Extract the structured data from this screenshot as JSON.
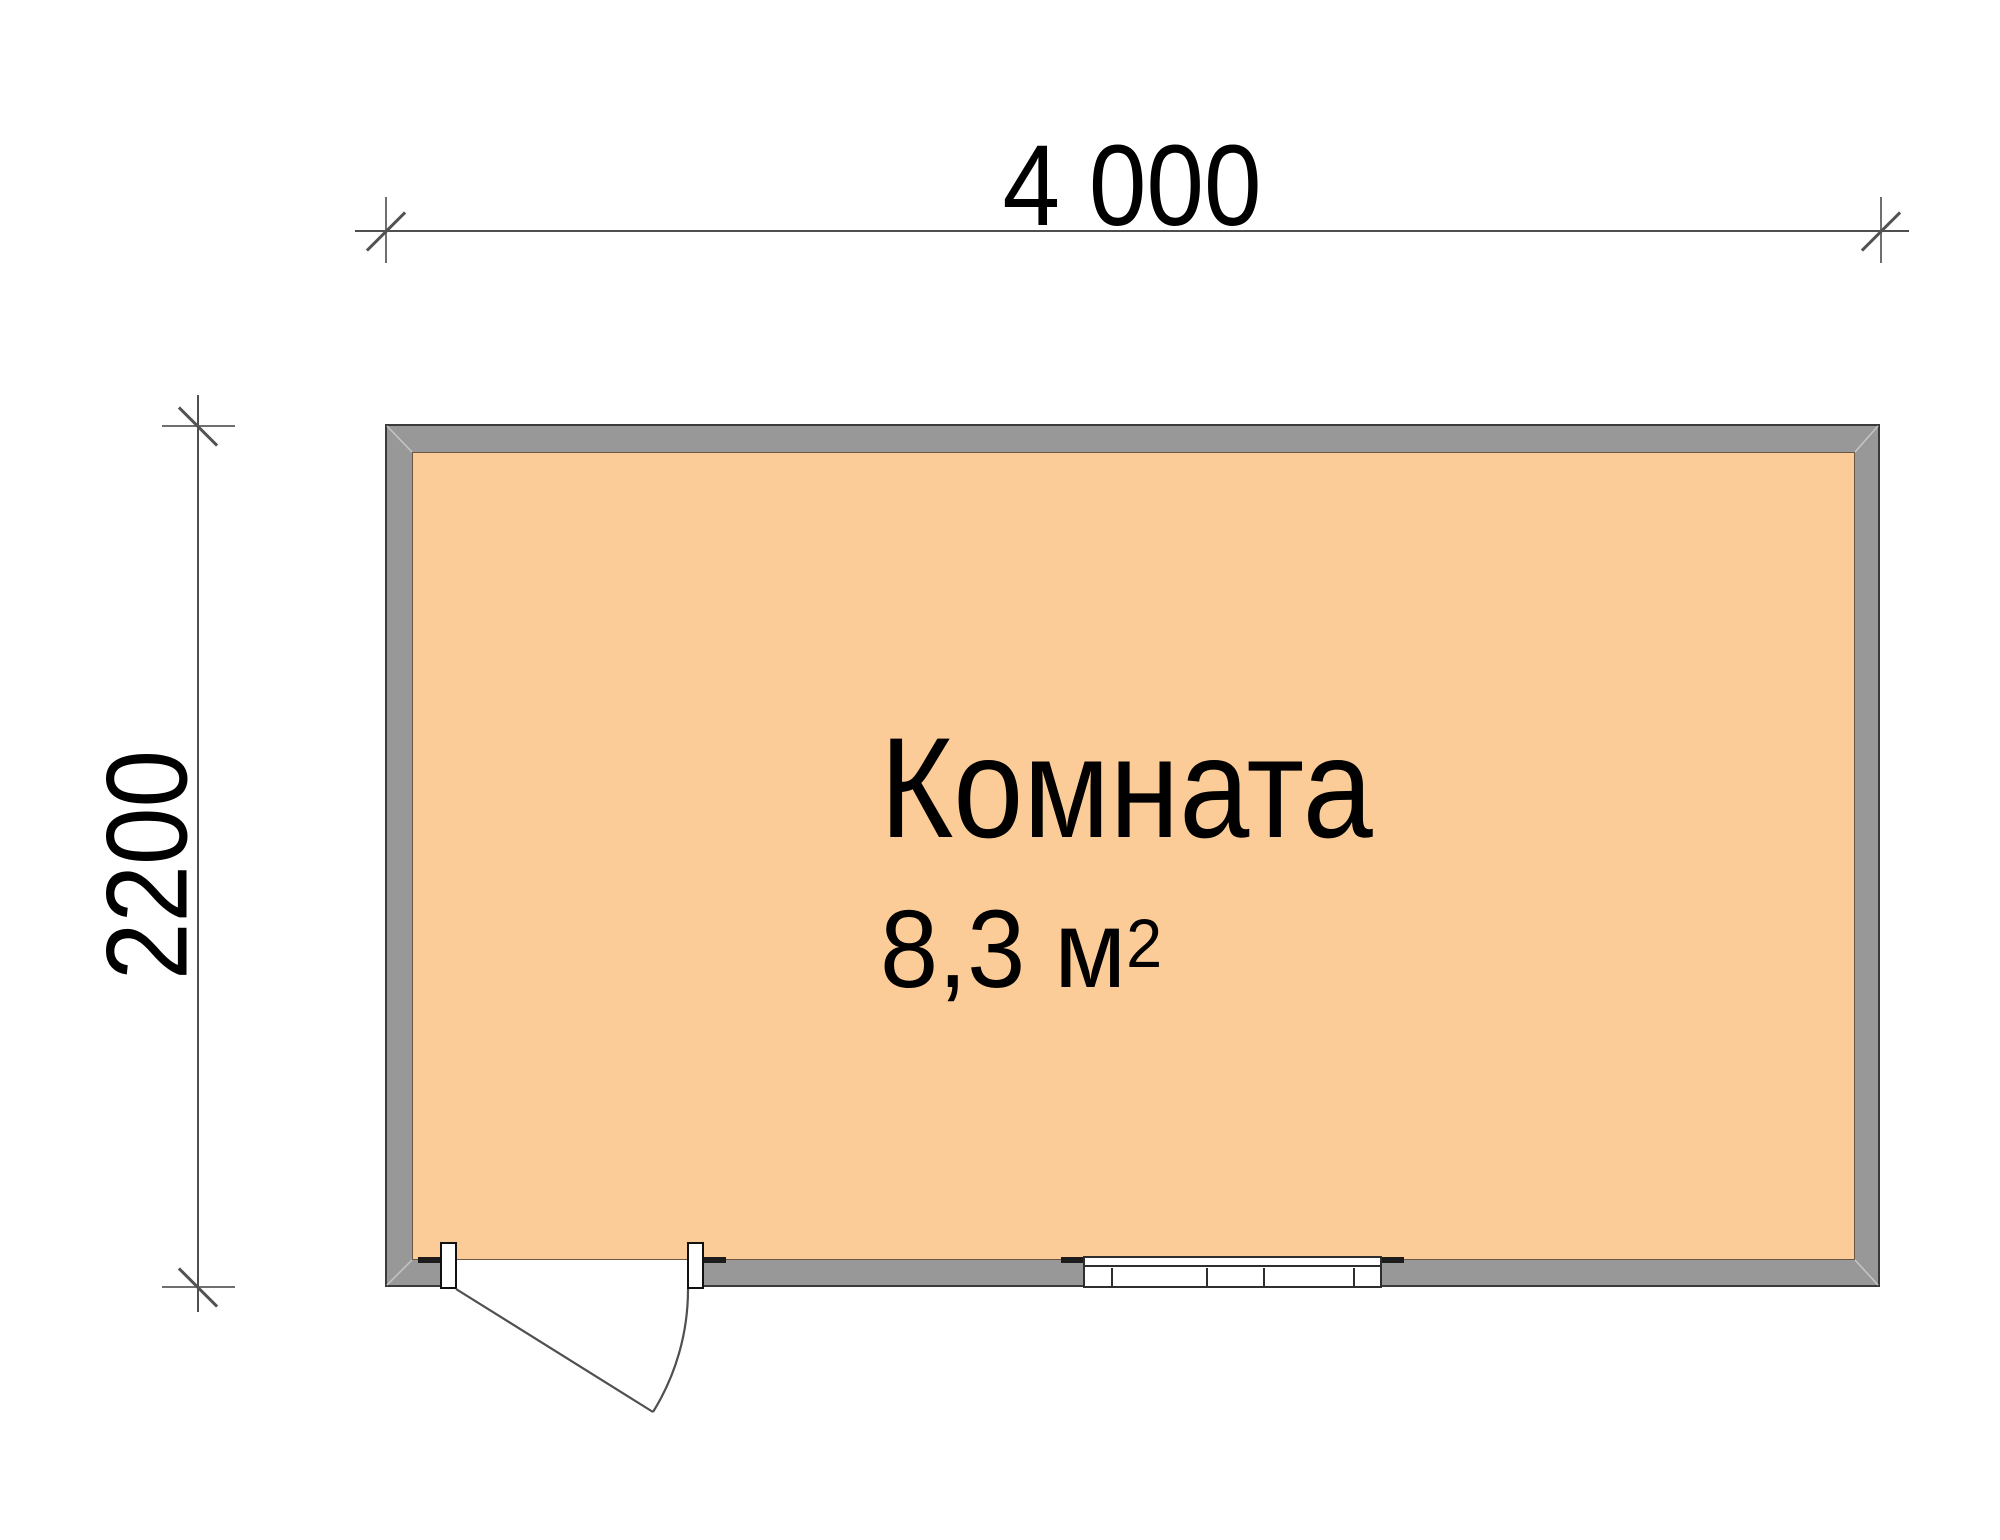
{
  "plan": {
    "type": "floor-plan",
    "room": {
      "name": "Комната",
      "area_text": "8,3 м",
      "area_superscript": "2"
    },
    "dimensions": {
      "width_label": "4 000",
      "height_label": "2200"
    },
    "features": {
      "door": "swing door in bottom-left wall",
      "window": "window in bottom wall, center-right"
    }
  },
  "colors": {
    "floor": "#fbcc97",
    "wall": "#989898",
    "wall-outline": "#3a3a3a",
    "room-outline": "#6b5744",
    "dim-line": "#4f4f4f",
    "ext-line": "#6f6f6f",
    "text": "#000000",
    "background": "#ffffff",
    "cap": "#1c1c1c"
  }
}
